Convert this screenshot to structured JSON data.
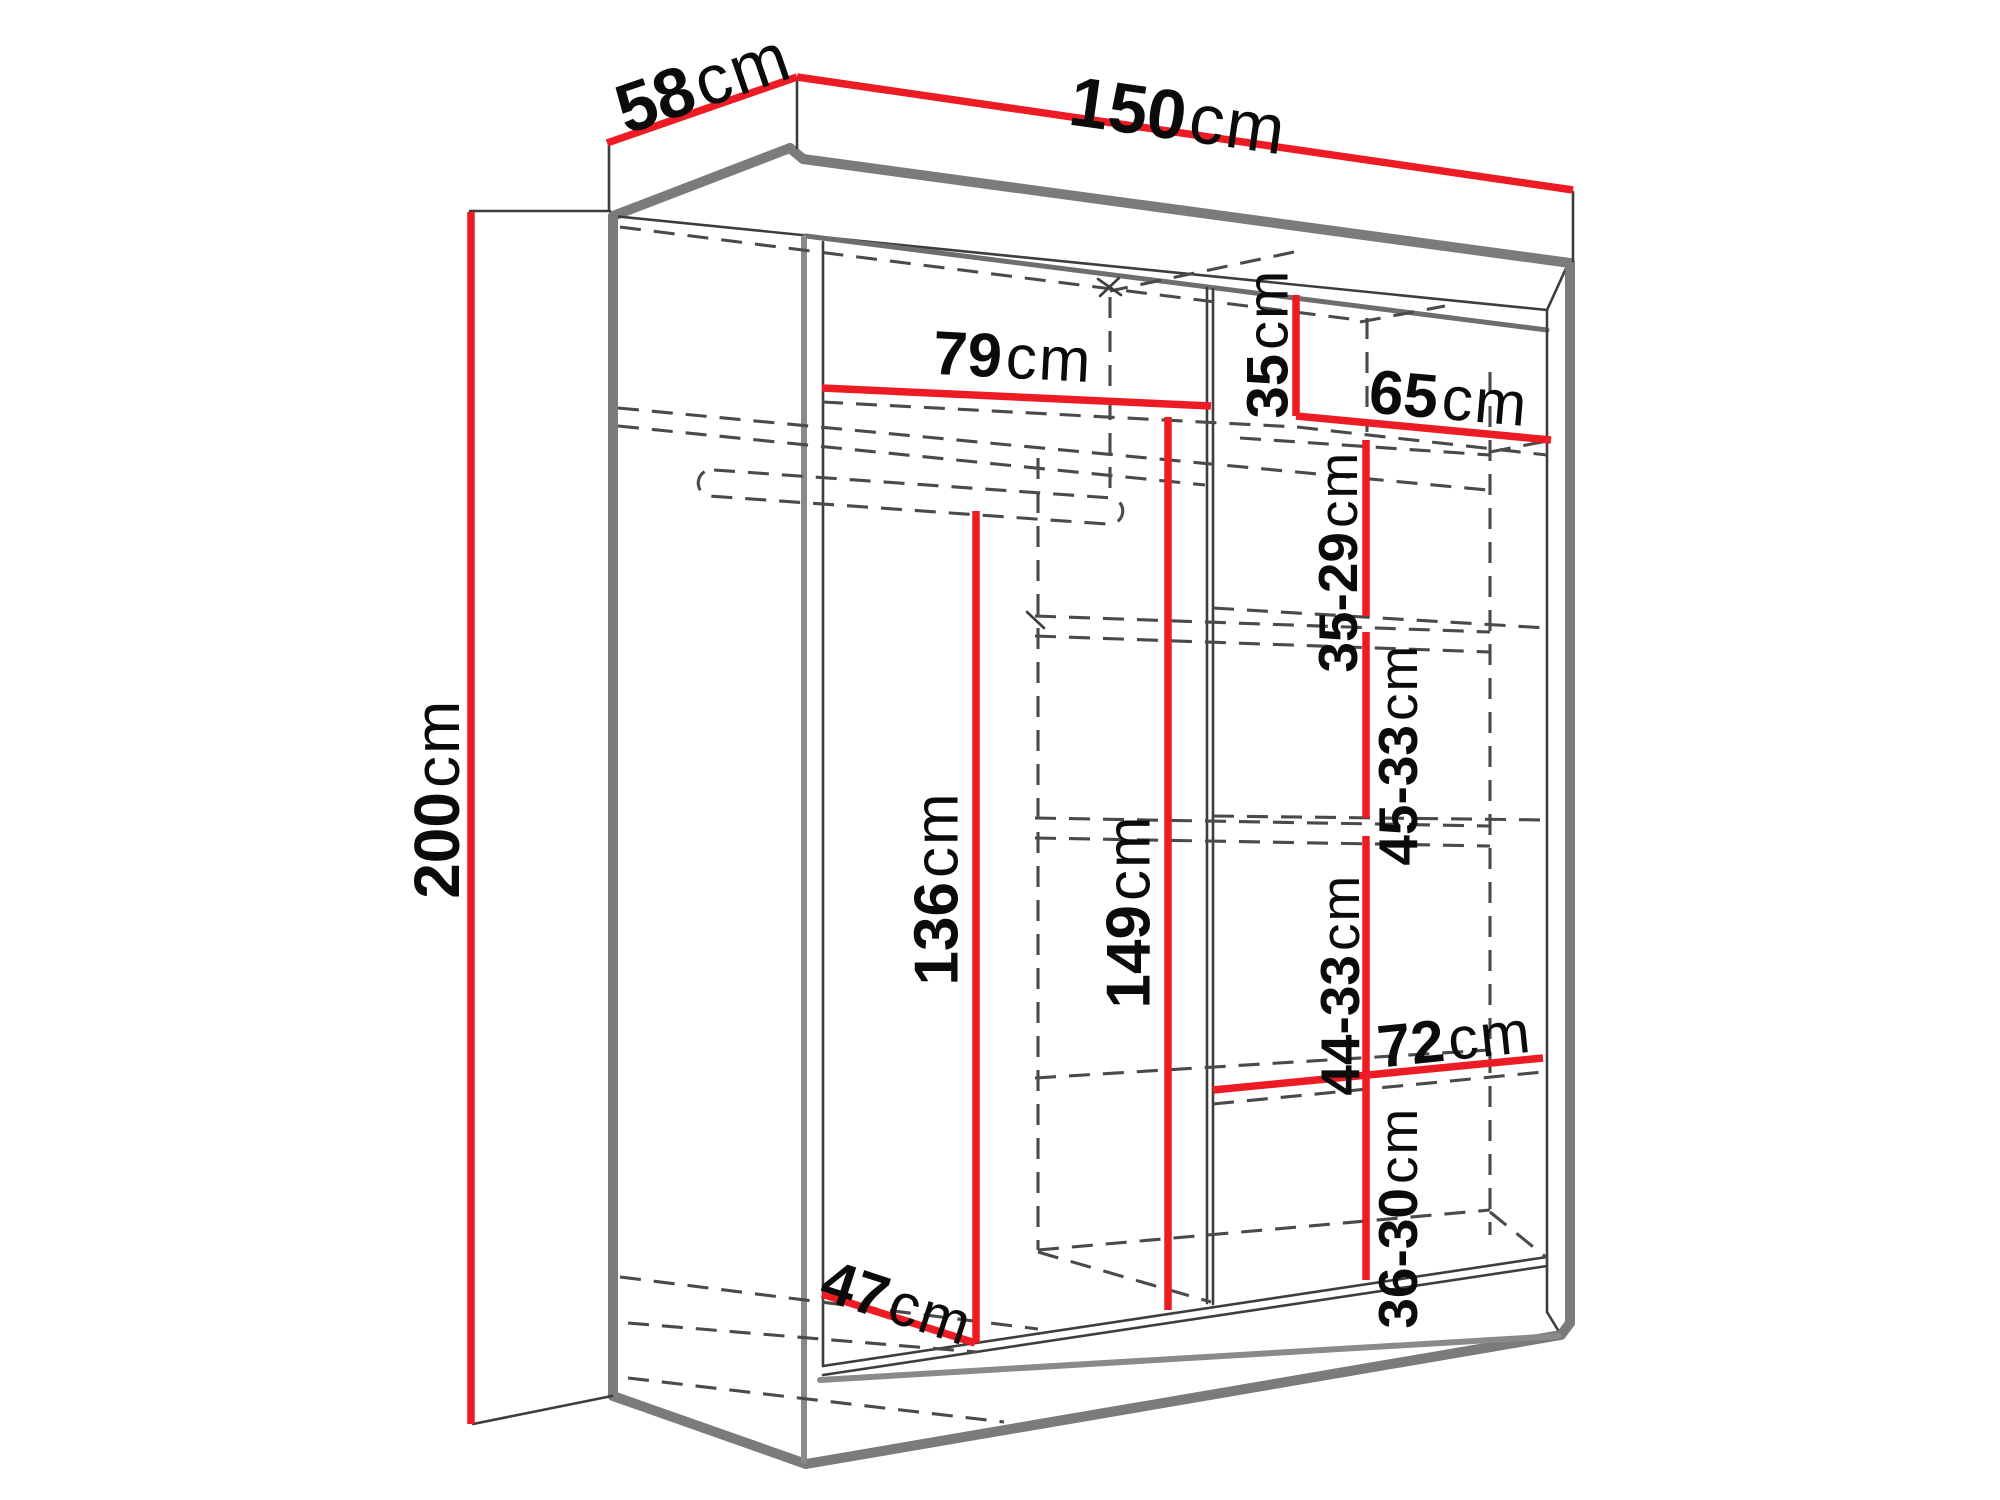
{
  "drawing": {
    "kind": "wardrobe-dimension-diagram",
    "background": "#ffffff"
  },
  "colors": {
    "dimension_red": "#ed1b24",
    "outline_gray": "#7b7b7b",
    "line_dark": "#3d3d3d",
    "dashed_gray": "#4a4a4a",
    "text_black": "#0b0b0b"
  },
  "dims": {
    "depth": {
      "value": "58",
      "unit": "cm"
    },
    "width": {
      "value": "150",
      "unit": "cm"
    },
    "height": {
      "value": "200",
      "unit": "cm"
    },
    "left_section_width": {
      "value": "79",
      "unit": "cm"
    },
    "top_shelf_gap": {
      "value": "35",
      "unit": "cm"
    },
    "right_section_width": {
      "value": "65",
      "unit": "cm"
    },
    "shelf_gap_1": {
      "value": "35-29",
      "unit": "cm"
    },
    "shelf_gap_2": {
      "value": "45-33",
      "unit": "cm"
    },
    "hanging_height": {
      "value": "136",
      "unit": "cm"
    },
    "interior_height": {
      "value": "149",
      "unit": "cm"
    },
    "shelf_gap_3": {
      "value": "44-33",
      "unit": "cm"
    },
    "shelf_width": {
      "value": "72",
      "unit": "cm"
    },
    "shelf_gap_4": {
      "value": "36-30",
      "unit": "cm"
    },
    "interior_depth": {
      "value": "47",
      "unit": "cm"
    }
  }
}
